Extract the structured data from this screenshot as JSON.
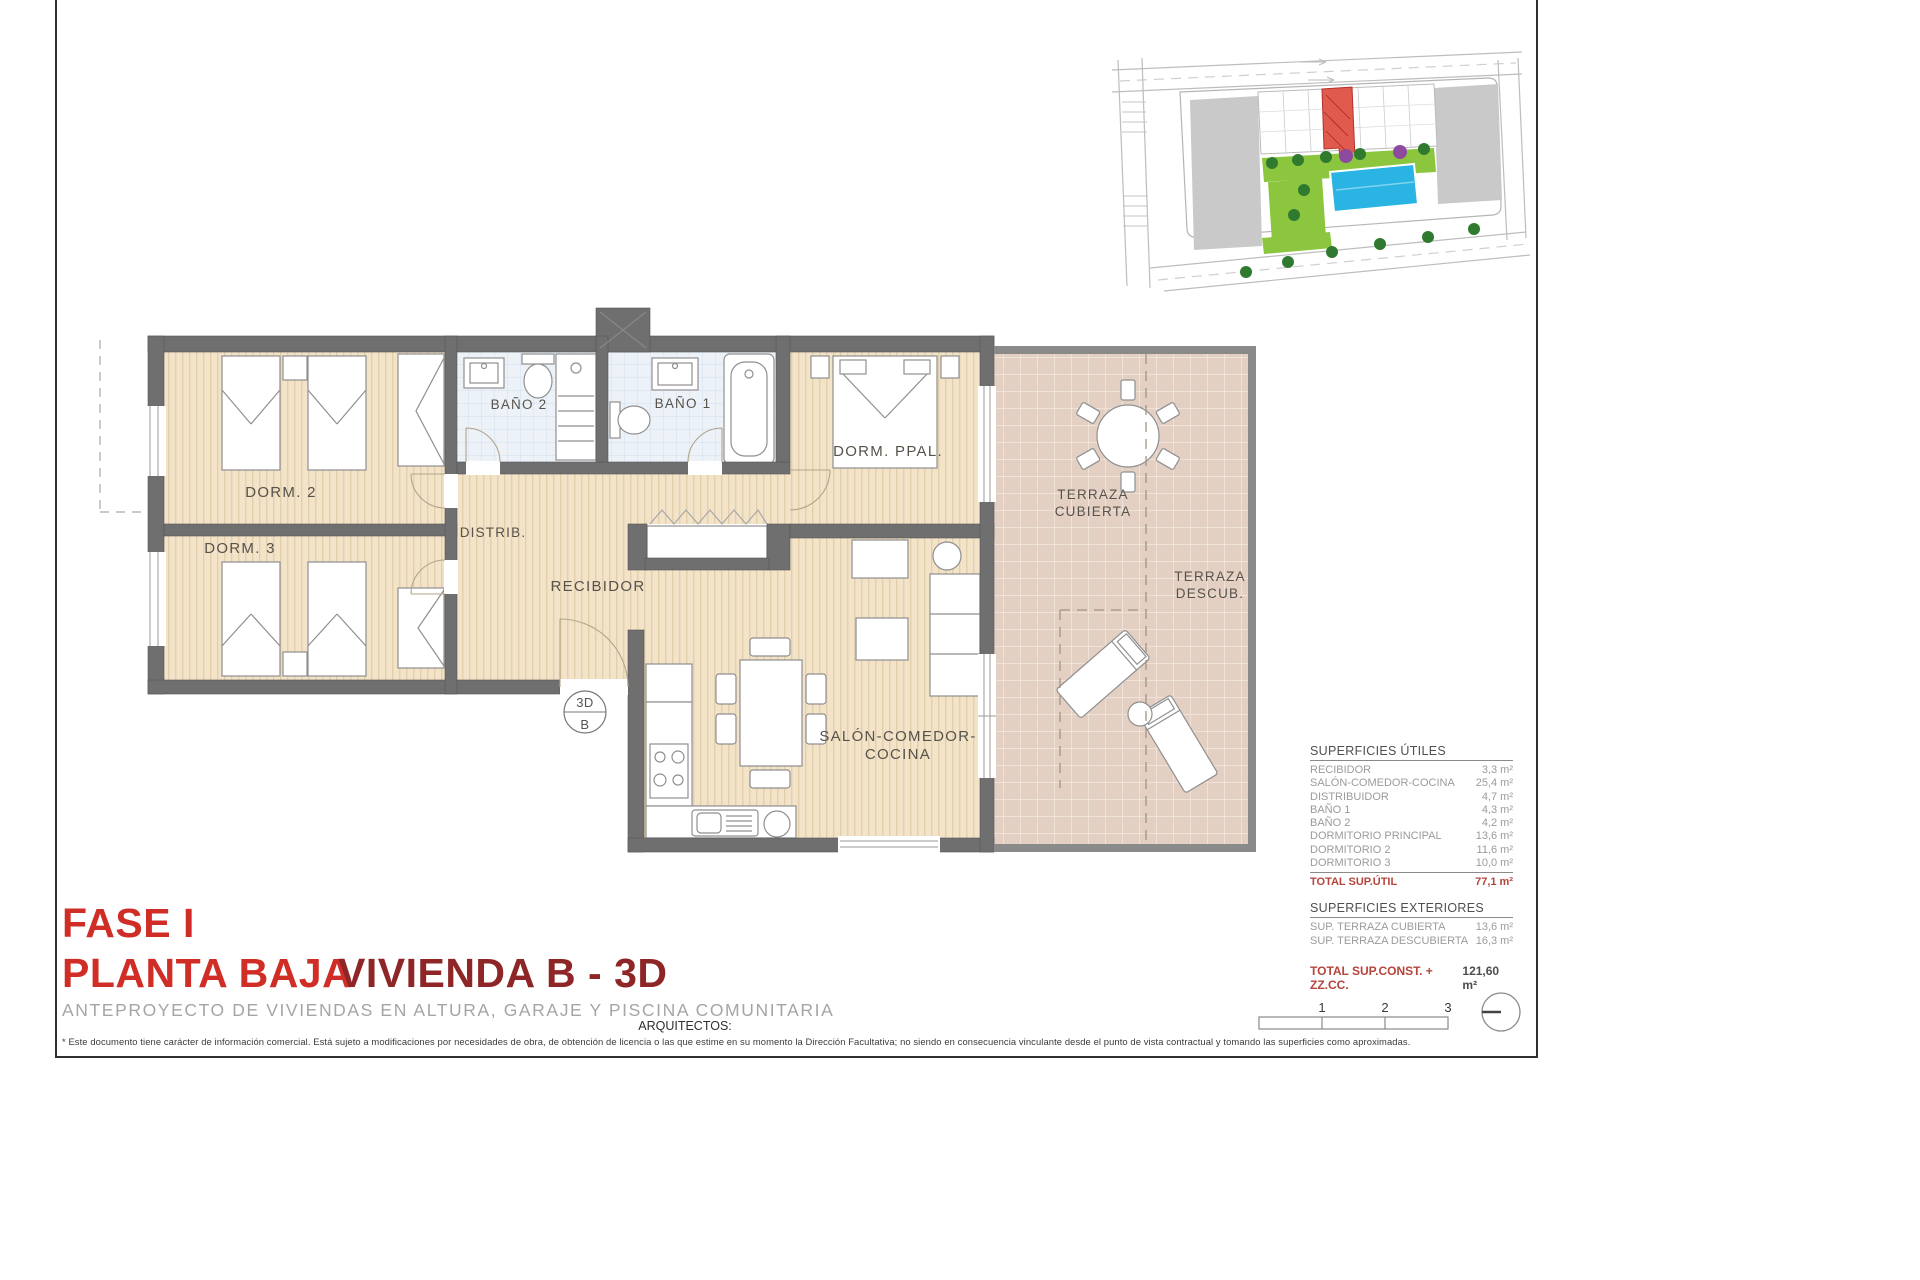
{
  "titles": {
    "phase": "FASE I",
    "floor": "PLANTA BAJA",
    "unit": "VIVIENDA B - 3D",
    "subtitle": "ANTEPROYECTO DE VIVIENDAS EN ALTURA, GARAJE Y PISCINA COMUNITARIA",
    "architects": "ARQUITECTOS:",
    "disclaimer": "* Este documento tiene carácter de información comercial. Está sujeto a modificaciones por necesidades de obra, de obtención de licencia o las que estime en su momento la Dirección Facultativa; no siendo en consecuencia vinculante desde el punto de vista contractual y tomando las superficies como aproximadas."
  },
  "plan": {
    "rooms": {
      "dorm2": "DORM. 2",
      "dorm3": "DORM. 3",
      "bano2": "BAÑO 2",
      "bano1": "BAÑO 1",
      "dorm_ppal": "DORM. PPAL.",
      "distrib": "DISTRIB.",
      "recibidor": "RECIBIDOR",
      "salon1": "SALÓN-COMEDOR-",
      "salon2": "COCINA",
      "terr_cub1": "TERRAZA",
      "terr_cub2": "CUBIERTA",
      "terr_des1": "TERRAZA",
      "terr_des2": "DESCUB."
    },
    "marker": {
      "top": "3D",
      "bottom": "B"
    }
  },
  "surfaces": {
    "utiles": {
      "title": "SUPERFICIES ÚTILES",
      "rows": [
        {
          "label": "RECIBIDOR",
          "value": "3,3 m²"
        },
        {
          "label": "SALÓN-COMEDOR-COCINA",
          "value": "25,4 m²"
        },
        {
          "label": "DISTRIBUIDOR",
          "value": "4,7 m²"
        },
        {
          "label": "BAÑO 1",
          "value": "4,3 m²"
        },
        {
          "label": "BAÑO 2",
          "value": "4,2 m²"
        },
        {
          "label": "DORMITORIO PRINCIPAL",
          "value": "13,6 m²"
        },
        {
          "label": "DORMITORIO 2",
          "value": "11,6 m²"
        },
        {
          "label": "DORMITORIO 3",
          "value": "10,0 m²"
        }
      ],
      "total_label": "TOTAL SUP.ÚTIL",
      "total_value": "77,1 m²"
    },
    "exteriores": {
      "title": "SUPERFICIES EXTERIORES",
      "rows": [
        {
          "label": "SUP. TERRAZA CUBIERTA",
          "value": "13,6 m²"
        },
        {
          "label": "SUP. TERRAZA DESCUBIERTA",
          "value": "16,3 m²"
        }
      ]
    },
    "grand_total": {
      "label": "TOTAL SUP.CONST. + ZZ.CC.",
      "value": "121,60 m²"
    }
  },
  "scalebar": {
    "tick1": "1",
    "tick2": "2",
    "tick3": "3"
  },
  "colors": {
    "wall": "#6f6f6f",
    "floor_wood": "#f2e3c9",
    "floor_bath": "#ecf2f8",
    "floor_terrace": "#e4cfc3",
    "accent_red": "#cf2d26",
    "accent_maroon": "#8e2627",
    "table_red": "#b5443c",
    "site_green": "#8cc63f",
    "site_pool": "#2ab4e3",
    "site_red_unit": "#e05a4e"
  }
}
